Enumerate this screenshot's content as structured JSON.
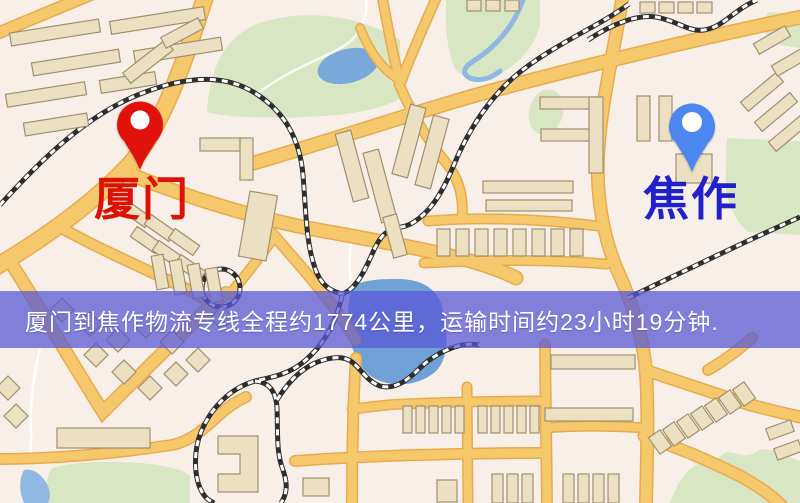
{
  "map": {
    "origin": {
      "label": "厦门",
      "marker_color": "#e1120b",
      "label_color": "#dd1206"
    },
    "destination": {
      "label": "焦作",
      "marker_color": "#4c86ef",
      "label_color": "#2121cc"
    }
  },
  "banner": {
    "text": "厦门到焦作物流专线全程约1774公里，运输时间约23小时19分钟.",
    "background_color": "#5858d4",
    "text_color": "#ffffff"
  },
  "palette": {
    "map_background": "#f8f0e8",
    "road_fill": "#f5c96b",
    "road_casing": "#e9aa4f",
    "building_fill": "#ece0c2",
    "building_stroke": "#a09070",
    "green_area": "#d8e6c4",
    "pond_water": "#79a9da",
    "lake_water": "#6fa0d6",
    "railway_dark": "#2e2e2e",
    "railway_light": "#ffffff"
  }
}
